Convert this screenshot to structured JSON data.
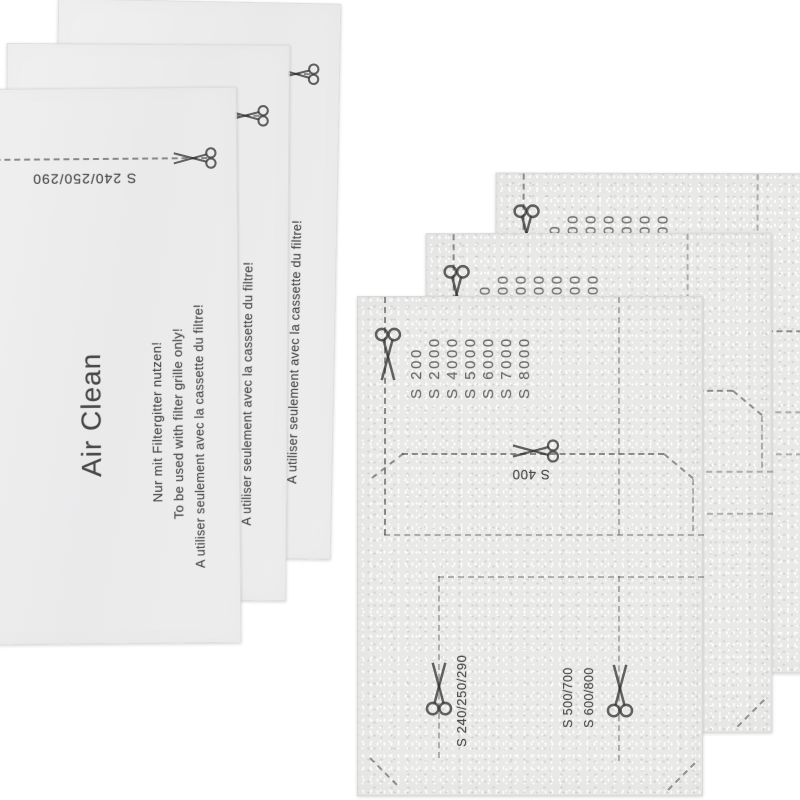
{
  "left_stack": {
    "sheet_count": 3,
    "brand": "Air Clean",
    "usage_note_de": "Nur mit Filtergitter nutzen!",
    "usage_note_en": "To be used with filter grille only!",
    "usage_note_fr": "A utiliser seulement avec la cassette du filtre!",
    "cut_line_label": "S 240/250/290"
  },
  "right_stack": {
    "sheet_count": 3,
    "top_cut_models": [
      "S 200",
      "S 2000",
      "S 4000",
      "S 5000",
      "S 6000",
      "S 7000",
      "S 8000"
    ],
    "middle_cut_label": "S 400",
    "bottom_left_cut_label": "S 240/250/290",
    "bottom_right_cut_labels": [
      "S 500/700",
      "S 600/800"
    ]
  },
  "colors": {
    "background": "#ffffff",
    "smooth_sheet": "#ececec",
    "fleece_sheet": "#e9e9e8",
    "print_ink": "#3d3d3d"
  }
}
